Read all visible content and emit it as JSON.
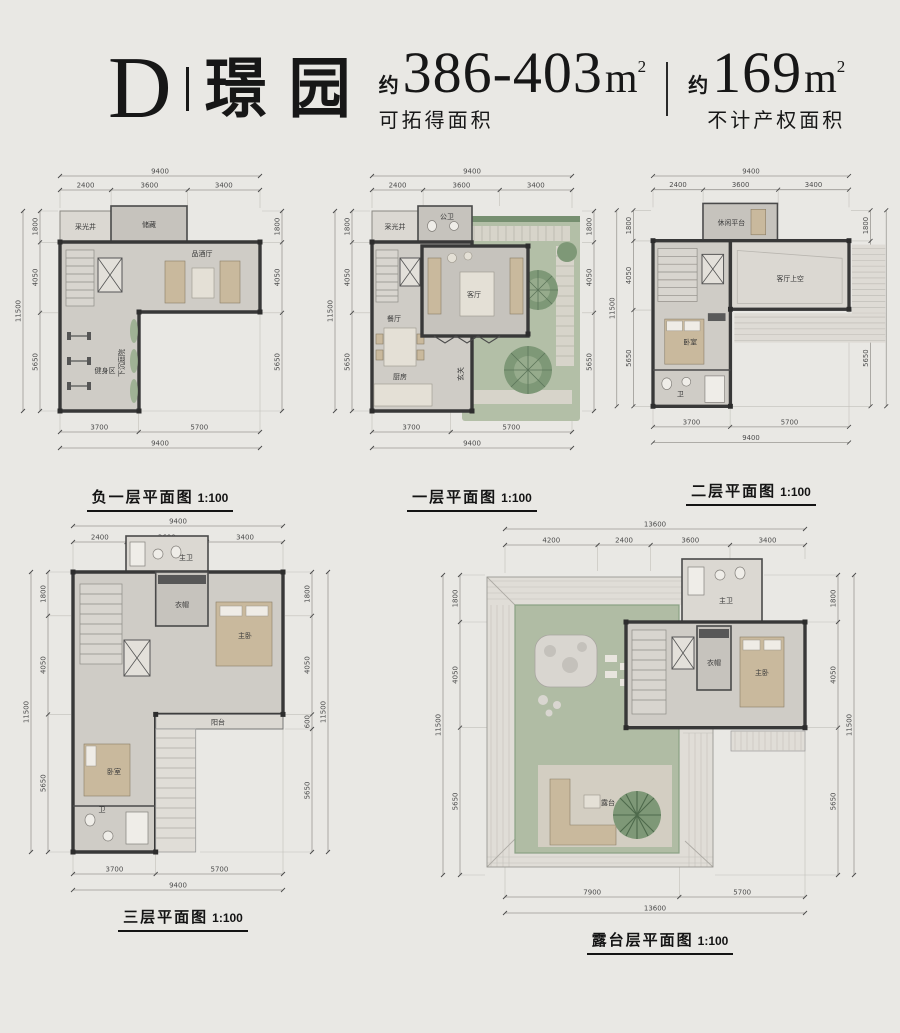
{
  "header": {
    "letter": "D",
    "name": "璟园",
    "area1": {
      "prefix": "约",
      "value": "386-403",
      "unit": "m",
      "sup": "2",
      "label": "可拓得面积"
    },
    "area2": {
      "prefix": "约",
      "value": "169",
      "unit": "m",
      "sup": "2",
      "label": "不计产权面积"
    }
  },
  "plans": [
    {
      "title": "负一层平面图",
      "scale": "1:100",
      "top_total": "9400",
      "top": [
        "2400",
        "3600",
        "3400"
      ],
      "side_total": "11500",
      "left": [
        "1800",
        "4050",
        "5650"
      ],
      "right": [
        "1800",
        "4050",
        "5650"
      ],
      "bottom": [
        "3700",
        "5700"
      ],
      "bottom_total": "9400",
      "rooms": [
        "采光井",
        "储藏",
        "品酒厅",
        "健身区",
        "下沉庭院"
      ]
    },
    {
      "title": "一层平面图",
      "scale": "1:100",
      "top_total": "9400",
      "top": [
        "2400",
        "3600",
        "3400"
      ],
      "side_total": "11500",
      "left": [
        "1800",
        "4050",
        "5650"
      ],
      "right": [
        "1800",
        "4050",
        "5650"
      ],
      "bottom": [
        "3700",
        "5700"
      ],
      "bottom_total": "9400",
      "rooms": [
        "采光井",
        "公卫",
        "客厅",
        "餐厅",
        "厨房",
        "玄关"
      ]
    },
    {
      "title": "二层平面图",
      "scale": "1:100",
      "top_total": "9400",
      "top": [
        "2400",
        "3600",
        "3400"
      ],
      "side_total": "11500",
      "left": [
        "1800",
        "4050",
        "5650"
      ],
      "right": [
        "1800",
        "4050",
        "5650"
      ],
      "bottom": [
        "3700",
        "5700"
      ],
      "bottom_total": "9400",
      "rooms": [
        "休闲平台",
        "客厅上空",
        "卧室",
        "卫"
      ]
    },
    {
      "title": "三层平面图",
      "scale": "1:100",
      "top_total": "9400",
      "top": [
        "2400",
        "3600",
        "3400"
      ],
      "side_total": "11500",
      "left": [
        "1800",
        "4050",
        "5650"
      ],
      "right": [
        "1800",
        "4050",
        "600",
        "5650"
      ],
      "bottom": [
        "3700",
        "5700"
      ],
      "bottom_total": "9400",
      "rooms": [
        "主卫",
        "衣帽",
        "主卧",
        "阳台",
        "卧室",
        "卫"
      ]
    },
    {
      "title": "露台层平面图",
      "scale": "1:100",
      "top_total": "13600",
      "top": [
        "4200",
        "2400",
        "3600",
        "3400"
      ],
      "side_total": "11500",
      "left": [
        "1800",
        "4050",
        "5650"
      ],
      "right": [
        "1800",
        "4050",
        "5650"
      ],
      "bottom": [
        "7900",
        "5700"
      ],
      "bottom_total": "13600",
      "rooms": [
        "主卫",
        "衣帽",
        "主卧",
        "露台"
      ]
    }
  ]
}
